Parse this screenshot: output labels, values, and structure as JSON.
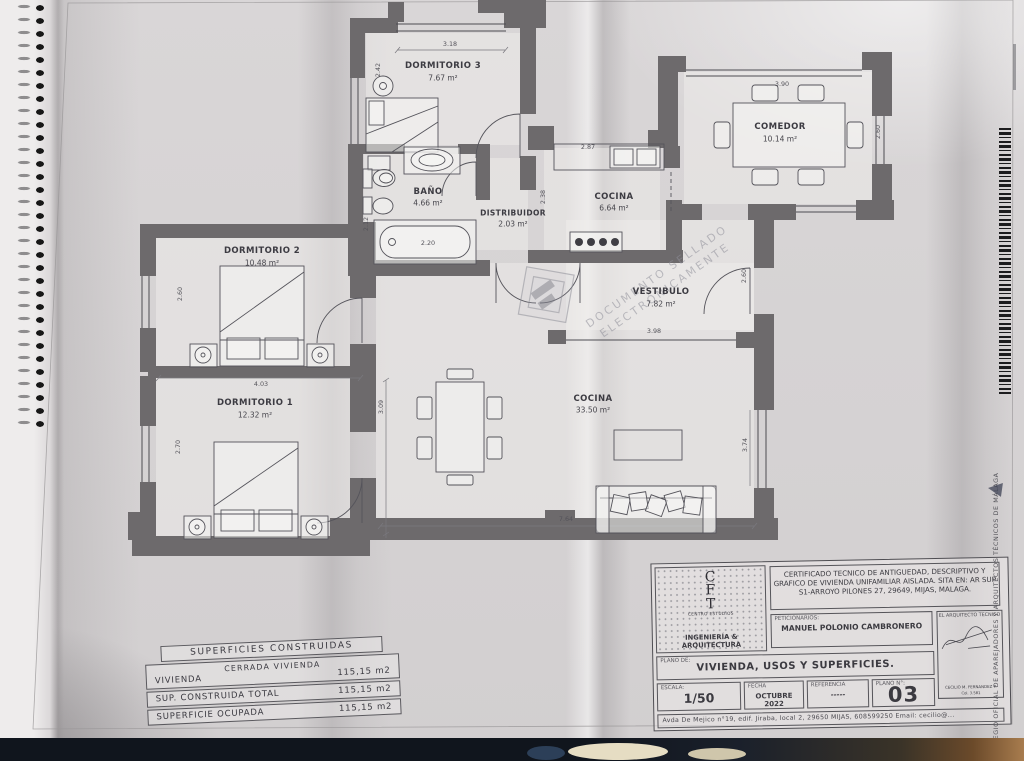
{
  "rooms": [
    {
      "name": "DORMITORIO 3",
      "area": "7.67 m²"
    },
    {
      "name": "BAÑO",
      "area": "4.66 m²"
    },
    {
      "name": "DISTRIBUIDOR",
      "area": "2.03 m²"
    },
    {
      "name": "COCINA",
      "area": "6.64 m²"
    },
    {
      "name": "COMEDOR",
      "area": "10.14 m²"
    },
    {
      "name": "DORMITORIO 2",
      "area": "10.48 m²"
    },
    {
      "name": "DORMITORIO 1",
      "area": "12.32 m²"
    },
    {
      "name": "VESTIBULO",
      "area": "7.82 m²"
    },
    {
      "name": "COCINA",
      "area": "33.50 m²"
    }
  ],
  "dims": {
    "dorm3_width": "3.18",
    "dorm3_height": "2.42",
    "bano_height": "2.12",
    "bathtub": "2.20",
    "kitchen_width": "2.87",
    "kitchen_height": "2.38",
    "comedor_width": "3.90",
    "comedor_height": "2.60",
    "vestibulo_height": "2.60",
    "vestibulo_width": "3.98",
    "dorm2_width": "4.03",
    "dorm2_height": "2.60",
    "dorm1_height": "2.70",
    "salon_height": "3.09",
    "salon_width": "7.64",
    "salon_right_height": "3.74"
  },
  "watermark": {
    "line1": "DOCUMENTO SELLADO",
    "line2": "ELECTRÓNICAMENTE"
  },
  "surfaces_table": {
    "title": "SUPERFICIES CONSTRUIDAS",
    "group_header": "CERRADA VIVIENDA",
    "rows": [
      {
        "label": "VIVIENDA",
        "value": "115,15 m2"
      },
      {
        "label": "SUP. CONSTRUIDA TOTAL",
        "value": "115,15 m2"
      },
      {
        "label": "SUPERFICIE OCUPADA",
        "value": "115,15 m2"
      }
    ]
  },
  "title_block": {
    "logo": {
      "letters": [
        "C",
        "F",
        "T"
      ],
      "subtitle": "CENTRO ESTUDIOS",
      "firm": "INGENIERÍA & ARQUITECTURA"
    },
    "certificate": "CERTIFICADO TECNICO DE ANTIGUEDAD, DESCRIPTIVO Y GRAFICO DE VIVIENDA UNIFAMILIAR AISLADA.  SITA EN: AR SUP S1-ARROYO PILONES 27, 29649, MIJAS, MALAGA.",
    "petitioners_label": "PETICIONARIOS:",
    "petitioners": "MANUEL POLONIO CAMBRONERO",
    "architect_label": "EL ARQUITECTO TECNICO",
    "architect_name": "CECILIO M. FERNANDEZ P.",
    "architect_number": "Col. 3.581",
    "plan_label": "PLANO DE:",
    "plan_title": "VIVIENDA, USOS Y SUPERFICIES.",
    "scale_label": "ESCALA:",
    "scale_value": "1/50",
    "date_label": "FECHA",
    "date_value": "OCTUBRE 2022",
    "reference_label": "REFERENCIA",
    "reference_value": "-----",
    "sheet_label": "PLANO N°:",
    "sheet_value": "03",
    "address": "Avda De Mejico n°19, edif. Jiraba, local 2, 29650 MIJAS, 608599250   Email: cecilio@..."
  },
  "margin": {
    "college": "COLEGIO OFICIAL DE APAREJADORES Y ARQUITECTOS TÉCNICOS DE MÁLAGA"
  }
}
